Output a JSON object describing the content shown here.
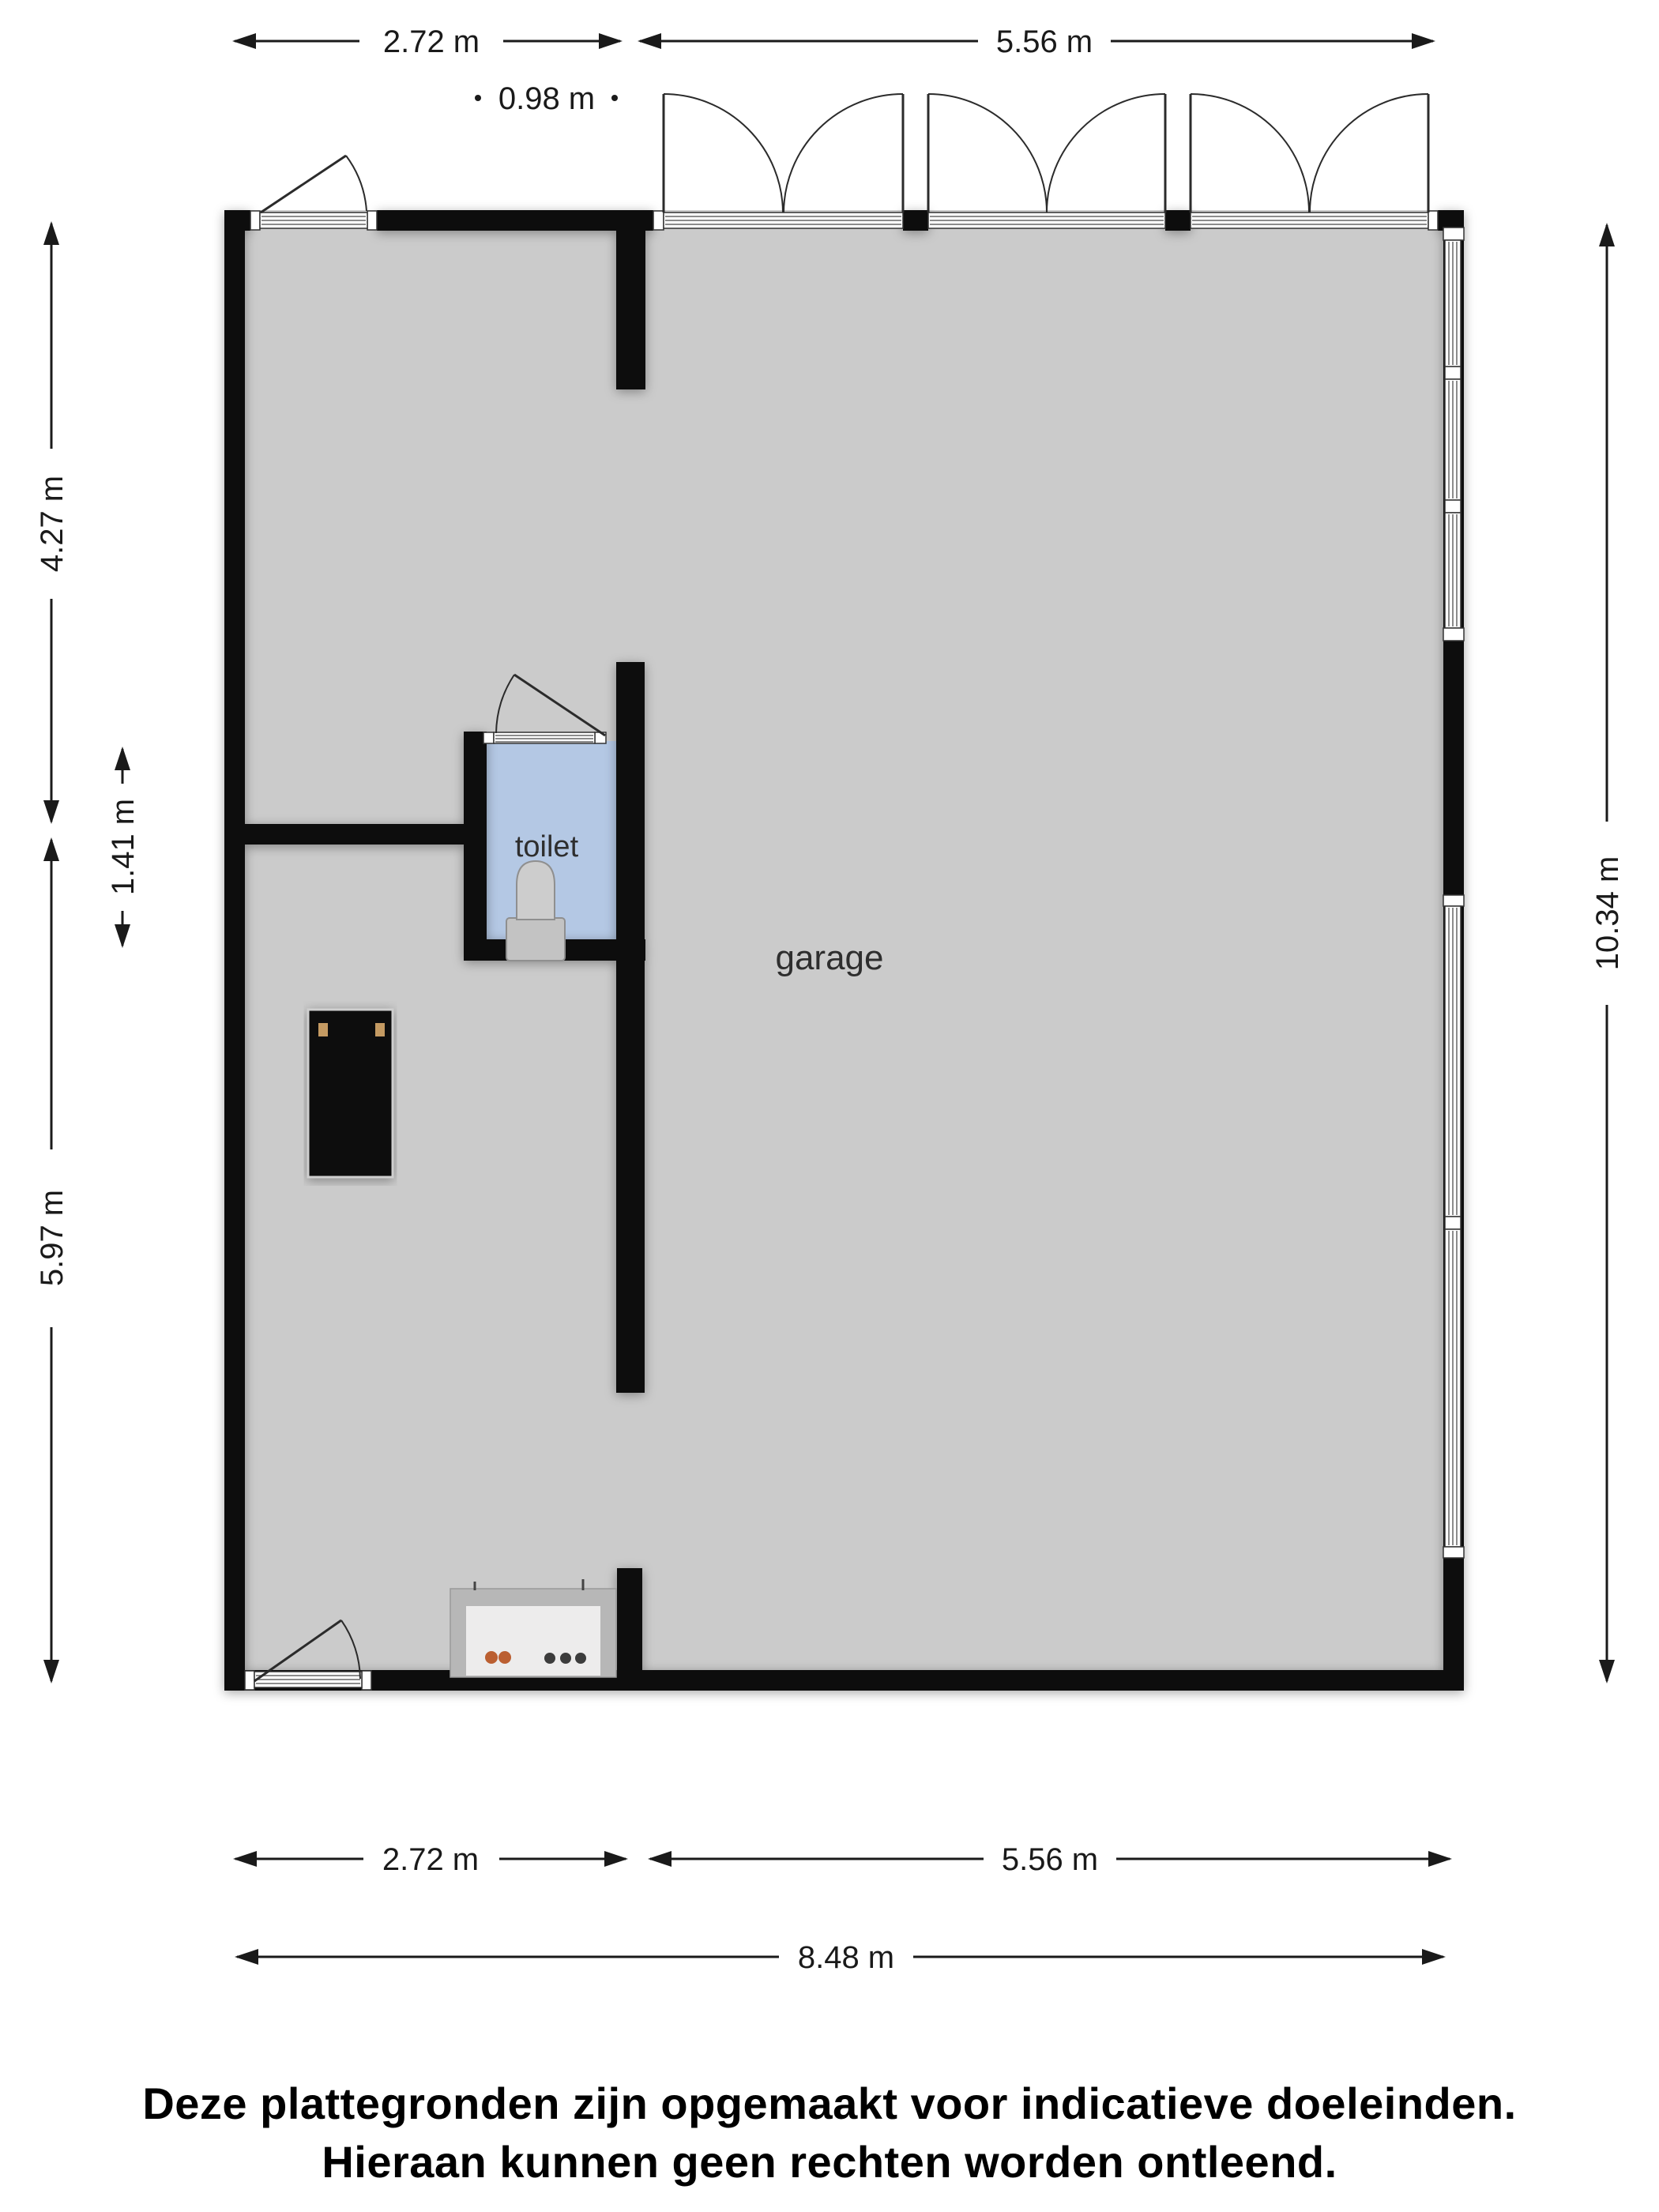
{
  "document": {
    "type": "floor-plan",
    "floor": "garage level"
  },
  "rooms": {
    "garage": "garage",
    "toilet": "toilet"
  },
  "dimensions": {
    "top_left": "2.72 m",
    "top_right": "5.56 m",
    "top_inner": "0.98 m",
    "left_upper": "4.27 m",
    "left_toilet": "1.41 m",
    "left_lower": "5.97 m",
    "right_full": "10.34 m",
    "bottom_left": "2.72 m",
    "bottom_right": "5.56 m",
    "bottom_full": "8.48 m"
  },
  "disclaimer": {
    "line1": "Deze plattegronden zijn opgemaakt voor indicatieve doeleinden.",
    "line2": "Hieraan kunnen geen rechten worden ontleend."
  },
  "colors": {
    "wall": "#0c0c0c",
    "garage_floor": "#cbcbcb",
    "toilet_floor": "#b4c8e4",
    "counter_body": "#b7b7b7",
    "counter_top": "#edecec",
    "cabinet": "#0b0b0b",
    "cabinet_hardware": "#c49a62",
    "dot_orange": "#bb5f31",
    "dot_dark": "#3c3c3c",
    "fixture": "#cdcdcd",
    "fixture_tank": "#c3c3c3",
    "dimension_ink": "#1a1a1a",
    "background": "#ffffff"
  }
}
